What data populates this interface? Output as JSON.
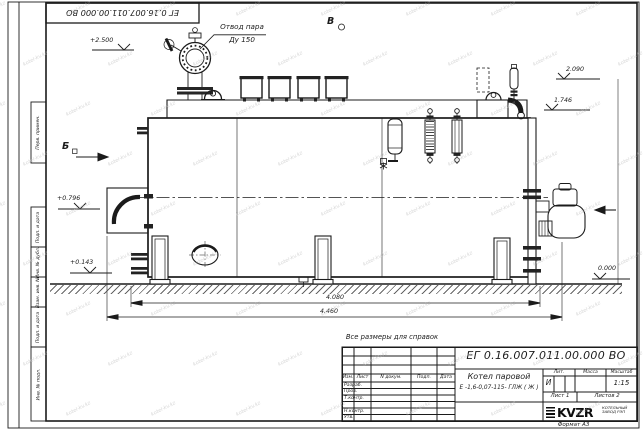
{
  "watermark": {
    "text": "kotel-kv.kz"
  },
  "frame": {
    "top_stamp": "ЕГ 0.16.007.011.00.000 ВО",
    "fields": [
      "Перв. примен.",
      "Подп. и дата",
      "Инв. № дубл.",
      "Взам. инв. №",
      "Подп. и дата",
      "Инв. № подл."
    ],
    "format_label": "Формат А3"
  },
  "drawing": {
    "note": "Все размеры для справок",
    "labels": {
      "steam1": "Отвод пара",
      "steam2": "Ду 150",
      "view_b": "Б",
      "view_v": "В"
    },
    "elevations": {
      "p2500": "+2.500",
      "p2090": "2.090",
      "p1746": "1.746",
      "p0796": "+0.796",
      "p0143": "+0.143",
      "p0000": "0.000"
    },
    "dimensions": {
      "inner": "4.080",
      "overall": "4.460"
    }
  },
  "title_block": {
    "doc_number": "ЕГ 0.16.007.011.00.000 ВО",
    "product_name": "Котел паровой",
    "product_type": "Е -1,6-0,07-115- ГЛЖ ( Ж )",
    "columns": {
      "izm": "Изм.",
      "list": "Лист",
      "doc": "N докум.",
      "podp": "Подп.",
      "data": "Дата"
    },
    "rows": {
      "razrab": "Разраб.",
      "prov": "Пров.",
      "tkontr": "Т.контр.",
      "nkontr": "Н.контр.",
      "utv": "Утв."
    },
    "lit_header": "Лит.",
    "mass_header": "Масса",
    "scale_header": "Масштаб",
    "lit_value": "И",
    "scale_value": "1:15",
    "sheet": "Лист 1",
    "sheets": "Листов 2",
    "logo": "KVZR",
    "company_line1": "КОТЕЛЬНЫЙ",
    "company_line2": "ЗАВОД РЭП",
    "format": "Формат А3"
  }
}
